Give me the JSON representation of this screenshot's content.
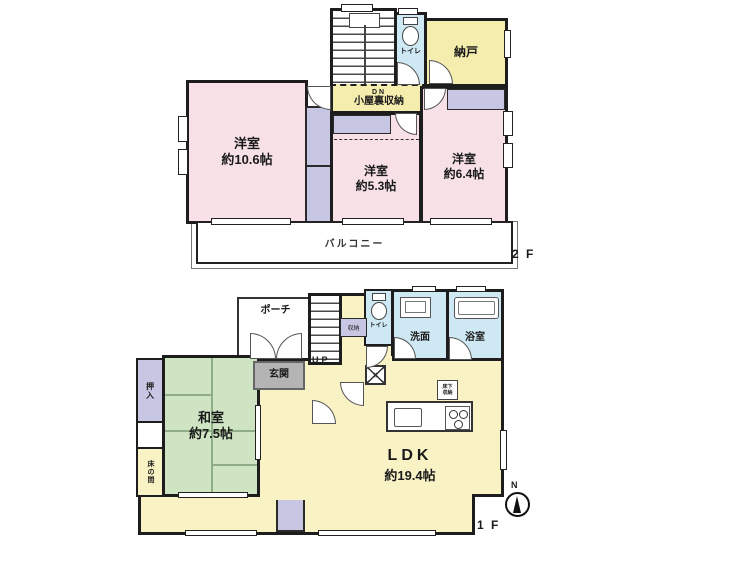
{
  "f2": {
    "floor_label": "2 F",
    "nando": {
      "label": "納戸"
    },
    "toilet": {
      "label": "トイレ"
    },
    "hall": {
      "dn": "DN",
      "label": "小屋裏収納"
    },
    "room1": {
      "name": "洋室",
      "size": "約10.6帖"
    },
    "room2": {
      "name": "洋室",
      "size": "約5.3帖"
    },
    "room3": {
      "name": "洋室",
      "size": "約6.4帖"
    },
    "balcony": {
      "label": "バルコニー"
    }
  },
  "f1": {
    "floor_label": "1 F",
    "porch": {
      "label": "ポーチ"
    },
    "genkan": {
      "label": "玄関"
    },
    "stairs": {
      "label": "UP"
    },
    "storage": {
      "label": "収納"
    },
    "toilet": {
      "label": "トイレ"
    },
    "washroom": {
      "label": "洗面"
    },
    "bathroom": {
      "label": "浴室"
    },
    "oshiire": {
      "label": "押入"
    },
    "tokonoma": {
      "label": "床の間"
    },
    "washitsu": {
      "name": "和室",
      "size": "約7.5帖"
    },
    "ldk": {
      "name": "LDK",
      "size": "約19.4帖"
    },
    "underfloor": {
      "line1": "床下",
      "line2": "収納"
    },
    "compass": {
      "label": "N"
    }
  },
  "colors": {
    "wall": "#1d1d1d",
    "room_pink": "#f7e1e7",
    "closet_purple": "#c7c7e3",
    "storage_yellow": "#f5edad",
    "ldk_yellow": "#f8f2c5",
    "tatami_green": "#cee4c3",
    "tatami_line": "#8fae85",
    "wet_blue": "#cfe9f4",
    "genkan_gray": "#b4b4b4"
  }
}
